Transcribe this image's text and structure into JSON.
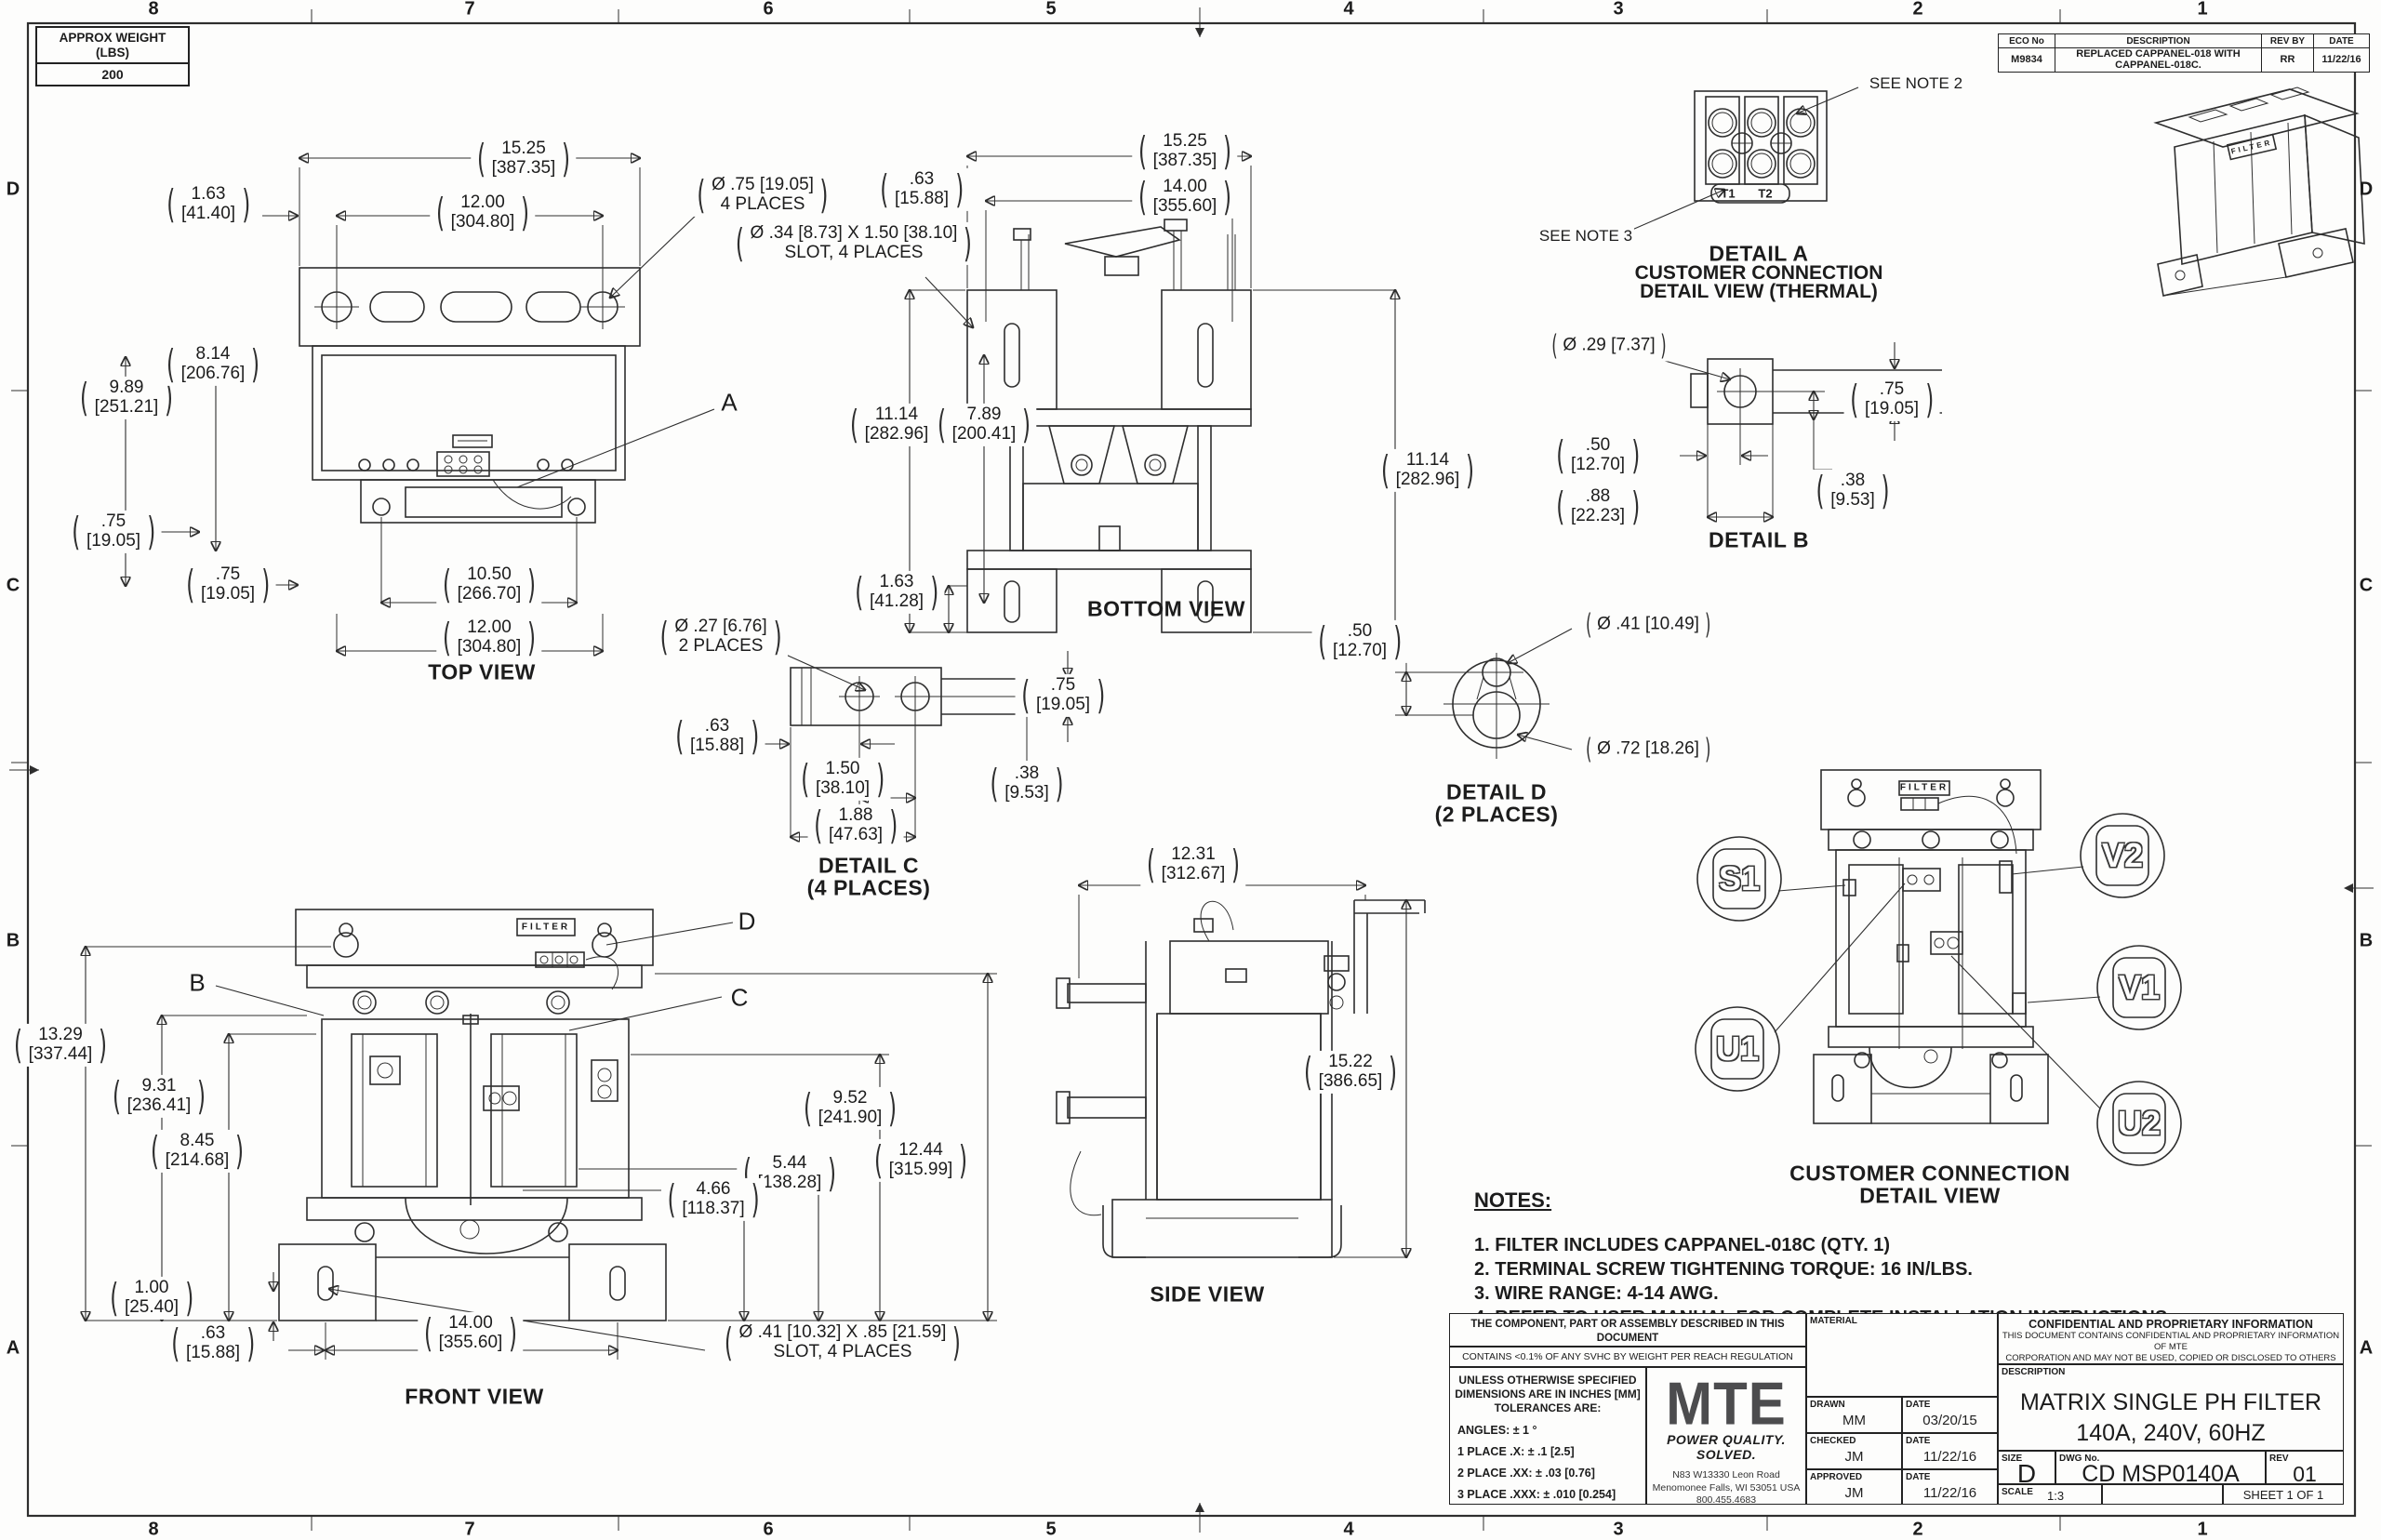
{
  "sheet": {
    "cols": [
      "8",
      "7",
      "6",
      "5",
      "4",
      "3",
      "2",
      "1"
    ],
    "rows": [
      "D",
      "C",
      "B",
      "A"
    ],
    "weight": {
      "line1": "APPROX WEIGHT",
      "line2": "(LBS)",
      "value": "200"
    },
    "eco": {
      "h1": "ECO No",
      "h2": "DESCRIPTION",
      "h3": "REV BY",
      "h4": "DATE",
      "no": "M9834",
      "desc": "REPLACED CAPPANEL-018 WITH CAPPANEL-018C.",
      "by": "RR",
      "date": "11/22/16"
    }
  },
  "views": {
    "top": "TOP VIEW",
    "bottom": "BOTTOM VIEW",
    "front": "FRONT VIEW",
    "side": "SIDE VIEW",
    "detail_a1": "DETAIL A",
    "detail_a2": "CUSTOMER CONNECTION",
    "detail_a3": "DETAIL VIEW (THERMAL)",
    "detail_b": "DETAIL B",
    "detail_c1": "DETAIL C",
    "detail_c2": "(4 PLACES)",
    "detail_d1": "DETAIL D",
    "detail_d2": "(2 PLACES)",
    "ccdv1": "CUSTOMER CONNECTION",
    "ccdv2": "DETAIL VIEW",
    "see_note_2": "SEE NOTE 2",
    "see_note_3": "SEE NOTE 3",
    "t1": "T1",
    "t2": "T2",
    "filter": "FILTER",
    "la": "A",
    "lb": "B",
    "lc": "C",
    "ld": "D",
    "balloons": [
      "S1",
      "V2",
      "U1",
      "V1",
      "U2"
    ]
  },
  "dims": {
    "d1525": {
      "a": "15.25",
      "b": "[387.35]"
    },
    "d1200": {
      "a": "12.00",
      "b": "[304.80]"
    },
    "d163a": {
      "a": "1.63",
      "b": "[41.40]"
    },
    "d163b": {
      "a": "1.63",
      "b": "[41.28]"
    },
    "d989": {
      "a": "9.89",
      "b": "[251.21]"
    },
    "d814": {
      "a": "8.14",
      "b": "[206.76]"
    },
    "d075": {
      "a": ".75",
      "b": "[19.05]"
    },
    "d1050": {
      "a": "10.50",
      "b": "[266.70]"
    },
    "d063": {
      "a": ".63",
      "b": "[15.88]"
    },
    "d1400": {
      "a": "14.00",
      "b": "[355.60]"
    },
    "d1114": {
      "a": "11.14",
      "b": "[282.96]"
    },
    "d789": {
      "a": "7.89",
      "b": "[200.41]"
    },
    "d050": {
      "a": ".50",
      "b": "[12.70]"
    },
    "d088": {
      "a": ".88",
      "b": "[22.23]"
    },
    "d038": {
      "a": ".38",
      "b": "[9.53]"
    },
    "d150": {
      "a": "1.50",
      "b": "[38.10]"
    },
    "d188": {
      "a": "1.88",
      "b": "[47.63]"
    },
    "d1329": {
      "a": "13.29",
      "b": "[337.44]"
    },
    "d931": {
      "a": "9.31",
      "b": "[236.41]"
    },
    "d845": {
      "a": "8.45",
      "b": "[214.68]"
    },
    "d100": {
      "a": "1.00",
      "b": "[25.40]"
    },
    "d952": {
      "a": "9.52",
      "b": "[241.90]"
    },
    "d1244": {
      "a": "12.44",
      "b": "[315.99]"
    },
    "d544": {
      "a": "5.44",
      "b": "[138.28]"
    },
    "d466": {
      "a": "4.66",
      "b": "[118.37]"
    },
    "d1231": {
      "a": "12.31",
      "b": "[312.67]"
    },
    "d1522": {
      "a": "15.22",
      "b": "[386.65]"
    }
  },
  "callouts": {
    "c075": {
      "l1": "Ø .75 [19.05]",
      "l2": "4 PLACES"
    },
    "c034": {
      "l1": "Ø .34 [8.73] X 1.50 [38.10]",
      "l2": "SLOT, 4 PLACES"
    },
    "c027": {
      "l1": "Ø .27 [6.76]",
      "l2": "2 PLACES"
    },
    "c029": {
      "l1": "Ø .29 [7.37]"
    },
    "c041a": {
      "l1": "Ø .41 [10.49]"
    },
    "c072": {
      "l1": "Ø .72 [18.26]"
    },
    "c041b": {
      "l1": "Ø .41 [10.32] X .85 [21.59]",
      "l2": "SLOT, 4 PLACES"
    }
  },
  "notes": {
    "heading": "NOTES:",
    "items": [
      "1.  FILTER INCLUDES CAPPANEL-018C (QTY. 1)",
      "2.  TERMINAL SCREW TIGHTENING TORQUE: 16 IN/LBS.",
      "3.  WIRE RANGE: 4-14 AWG.",
      "4.  REFER TO USER MANUAL FOR COMPLETE INSTALLATION INSTRUCTIONS."
    ]
  },
  "tb": {
    "rohs_l1": "THE COMPONENT, PART OR ASSEMBLY DESCRIBED IN THIS DOCUMENT",
    "rohs_l2": "MUST COMPLY WITH THE EU(EUROPEAN UNION) DIRECTIVE RoHS2",
    "reach": "CONTAINS <0.1% OF ANY SVHC BY WEIGHT PER REACH REGULATION",
    "tol_h1": "UNLESS OTHERWISE SPECIFIED",
    "tol_h2": "DIMENSIONS ARE IN INCHES [MM]",
    "tol_h3": "TOLERANCES ARE:",
    "tol_angles": "ANGLES: ± 1 °",
    "tol_1": "1 PLACE .X: ± .1 [2.5]",
    "tol_2": "2 PLACE .XX: ± .03 [0.76]",
    "tol_3": "3 PLACE .XXX: ± .010 [0.254]",
    "logo": "MTE",
    "tagline": "POWER QUALITY. SOLVED.",
    "addr1": "N83 W13330 Leon Road",
    "addr2": "Menomonee Falls, WI 53051 USA",
    "addr3": "800.455.4683",
    "addr4": "262.253.8200",
    "material": "MATERIAL",
    "drawn": "DRAWN",
    "drawn_v": "MM",
    "date_drawn": "03/20/15",
    "checked": "CHECKED",
    "checked_v": "JM",
    "date_checked": "11/22/16",
    "approved": "APPROVED",
    "approved_v": "JM",
    "date_approved": "11/22/16",
    "date": "DATE",
    "conf_t": "CONFIDENTIAL AND PROPRIETARY INFORMATION",
    "conf_1": "THIS DOCUMENT CONTAINS CONFIDENTIAL AND PROPRIETARY INFORMATION OF MTE",
    "conf_2": "CORPORATION AND MAY NOT BE USED, COPIED OR DISCLOSED TO OTHERS EXCEPT",
    "conf_3": "WITH THE AUTHORIZED WRITTEN PERMISSION OF MTE CORPORATION",
    "desc_l": "DESCRIPTION",
    "desc_1": "MATRIX SINGLE PH FILTER",
    "desc_2": "140A, 240V, 60HZ",
    "size_l": "SIZE",
    "size_v": "D",
    "dwg_l": "DWG No.",
    "dwg_v": "CD MSP0140A",
    "rev_l": "REV",
    "rev_v": "01",
    "scale_l": "SCALE",
    "scale_v": "1:3",
    "sheet_v": "SHEET 1  OF 1"
  }
}
